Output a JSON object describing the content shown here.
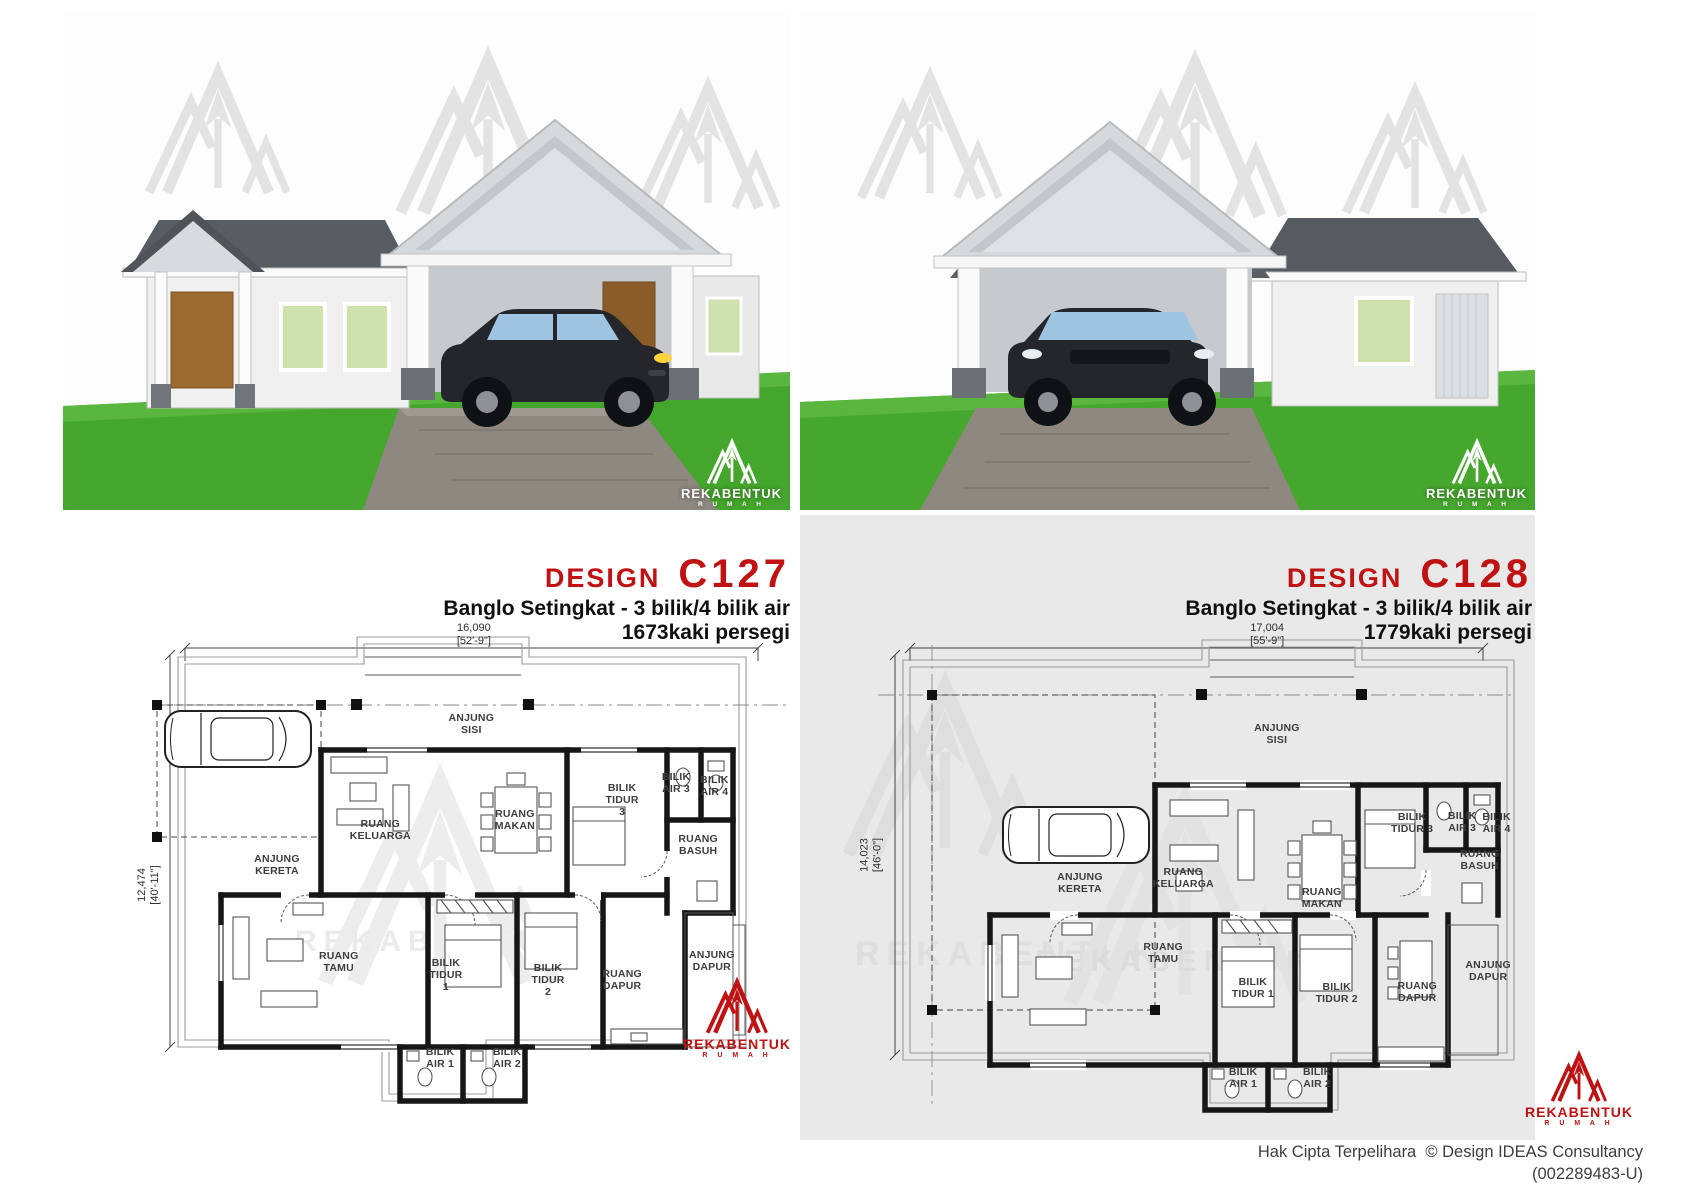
{
  "brand": {
    "name": "REKABENTUK",
    "sub": "R U M A H",
    "red": "#c01212"
  },
  "footer": {
    "line1": "Hak Cipta Terpelihara  © Design IDEAS Consultancy",
    "line2": "(002289483-U)"
  },
  "designs": [
    {
      "label": "DESIGN",
      "code": "C127",
      "subtitle": "Banglo Setingkat - 3 bilik/4 bilik air",
      "area": "1673kaki persegi",
      "dim_top_mm": "16,090",
      "dim_top_ft": "[52'-9\"]",
      "dim_left_mm": "12,474",
      "dim_left_ft": "[40'-11\"]",
      "rooms": [
        {
          "label": "ANJUNG\nSISI",
          "x": 50.2,
          "y": 24.8
        },
        {
          "label": "RUANG\nKELUARGA",
          "x": 36.2,
          "y": 45.2
        },
        {
          "label": "RUANG\nMAKAN",
          "x": 56.9,
          "y": 43.3
        },
        {
          "label": "BILIK\nTIDUR\n3",
          "x": 73.4,
          "y": 39.4
        },
        {
          "label": "BILIK\nAIR 3",
          "x": 81.7,
          "y": 36.2
        },
        {
          "label": "BILIK\nAIR 4",
          "x": 87.6,
          "y": 36.7
        },
        {
          "label": "RUANG\nBASUH",
          "x": 85.1,
          "y": 48.1
        },
        {
          "label": "ANJUNG\nKERETA",
          "x": 20.3,
          "y": 51.9
        },
        {
          "label": "RUANG\nTAMU",
          "x": 29.8,
          "y": 70.6
        },
        {
          "label": "BILIK\nTIDUR\n1",
          "x": 46.3,
          "y": 73.1
        },
        {
          "label": "BILIK\nTIDUR\n2",
          "x": 62.0,
          "y": 74.0
        },
        {
          "label": "RUANG\nDAPUR",
          "x": 73.4,
          "y": 74.0
        },
        {
          "label": "ANJUNG\nDAPUR",
          "x": 87.2,
          "y": 70.4
        },
        {
          "label": "BILIK\nAIR 1",
          "x": 45.4,
          "y": 89.0
        },
        {
          "label": "BILIK\nAIR 2",
          "x": 55.7,
          "y": 89.0
        }
      ]
    },
    {
      "label": "DESIGN",
      "code": "C128",
      "subtitle": "Banglo Setingkat - 3 bilik/4 bilik air",
      "area": "1779kaki persegi",
      "dim_top_mm": "17,004",
      "dim_top_ft": "[55'-9\"]",
      "dim_left_mm": "14,023",
      "dim_left_ft": "[46'-0\"]",
      "rooms": [
        {
          "label": "ANJUNG\nSISI",
          "x": 62.6,
          "y": 26.7
        },
        {
          "label": "ANJUNG\nKERETA",
          "x": 32.3,
          "y": 55.4
        },
        {
          "label": "RUANG\nKELUARGA",
          "x": 48.2,
          "y": 54.4
        },
        {
          "label": "RUANG\nMAKAN",
          "x": 69.5,
          "y": 58.3
        },
        {
          "label": "BILIK\nTIDUR 3",
          "x": 83.4,
          "y": 43.8
        },
        {
          "label": "BILIK\nAIR 3",
          "x": 91.1,
          "y": 43.7
        },
        {
          "label": "BILIK\nAIR 4",
          "x": 96.4,
          "y": 43.8
        },
        {
          "label": "RUANG\nBASUH",
          "x": 93.8,
          "y": 51.0
        },
        {
          "label": "RUANG\nTAMU",
          "x": 45.1,
          "y": 68.8
        },
        {
          "label": "BILIK\nTIDUR 1",
          "x": 58.9,
          "y": 75.6
        },
        {
          "label": "BILIK\nTIDUR 2",
          "x": 71.8,
          "y": 76.5
        },
        {
          "label": "RUANG\nDAPUR",
          "x": 84.2,
          "y": 76.3
        },
        {
          "label": "ANJUNG\nDAPUR",
          "x": 95.1,
          "y": 72.3
        },
        {
          "label": "BILIK\nAIR 1",
          "x": 57.4,
          "y": 92.9
        },
        {
          "label": "BILIK\nAIR 2",
          "x": 68.8,
          "y": 92.9
        }
      ]
    }
  ]
}
